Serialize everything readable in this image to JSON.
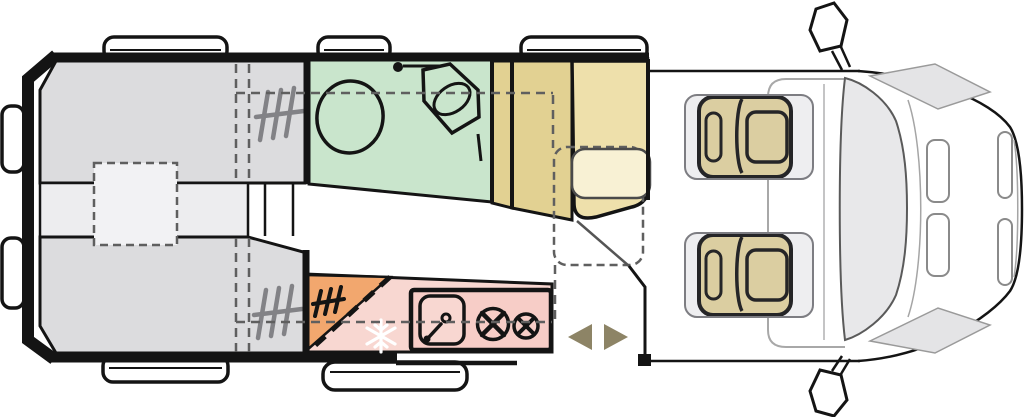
{
  "diagram": {
    "type": "motorhome-floorplan-top-view",
    "description": "Camper van floor plan seen from above; rear of vehicle at left, driver cab at right",
    "colors": {
      "outline": "#141414",
      "dashed_guide": "#5f5f5f",
      "hatch_gray": "#828286",
      "windshield": "#e8e8ea",
      "cowl": "#e4e4e6",
      "cab_gray_line": "#a8a8a8"
    },
    "zones": {
      "rear_bed_top": {
        "label": "single-bed-left",
        "color": "#dcdcde"
      },
      "rear_bed_bottom": {
        "label": "single-bed-right",
        "color": "#dcdcde"
      },
      "aisle": {
        "label": "aisle-between-beds",
        "color": "#ededef"
      },
      "bed_infill": {
        "label": "infill-cushion-dashed",
        "color": "#f2f2f4"
      },
      "bathroom": {
        "label": "bathroom",
        "color": "#c9e5cc"
      },
      "wardrobe": {
        "label": "wardrobe-cabinet",
        "color": "#e2d192"
      },
      "dinette_bench": {
        "label": "dinette-bench",
        "color": "#eee0ab"
      },
      "table": {
        "label": "table",
        "color": "#f8f1d4"
      },
      "kitchen": {
        "label": "kitchen-counter-slab",
        "color": "#f8d7d1"
      },
      "kitchen_unit": {
        "label": "sink-and-hob-unit",
        "color": "#f7cdc7"
      },
      "fridge": {
        "label": "fridge-freezer",
        "color": "#f2a76e"
      },
      "cab_seat": {
        "label": "swivel-cab-seat",
        "color": "#e9d9a1"
      },
      "door_arrows": {
        "label": "sliding-door-direction",
        "color": "#8d8466"
      }
    },
    "icons": [
      "toilet-icon",
      "washbasin-icon",
      "shower-head-icon",
      "snowflake-icon",
      "sink-icon",
      "faucet-icon",
      "burner-icon",
      "hatch-marks-icon",
      "mirror-icon",
      "window-bump",
      "door-arrow-icon"
    ]
  }
}
